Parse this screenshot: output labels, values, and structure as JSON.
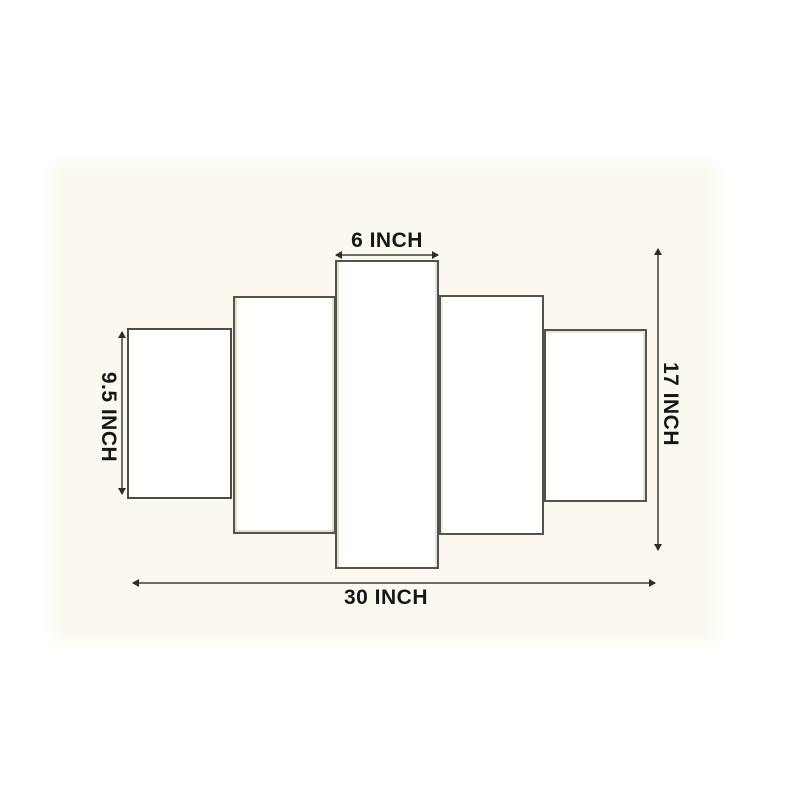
{
  "diagram": {
    "kind": "5-panel wall art dimension diagram",
    "panel_count": 5
  },
  "measurements": {
    "top_width": {
      "label": "6 INCH",
      "value": 6,
      "unit": "inch"
    },
    "left_height": {
      "label": "9.5 INCH",
      "value": 9.5,
      "unit": "inch"
    },
    "right_height": {
      "label": "17 INCH",
      "value": 17,
      "unit": "inch"
    },
    "bottom_width": {
      "label": "30 INCH",
      "value": 30,
      "unit": "inch"
    }
  },
  "colors": {
    "page_background": "#ffffff",
    "photo_background": "#fbf9ef",
    "panel_fill": "#fffffe",
    "panel_border": "#55524a",
    "dimension_line": "#6f6d66",
    "arrowhead": "#2e2d29",
    "label_text": "#161616",
    "gold_speckle": "#c89a52"
  }
}
